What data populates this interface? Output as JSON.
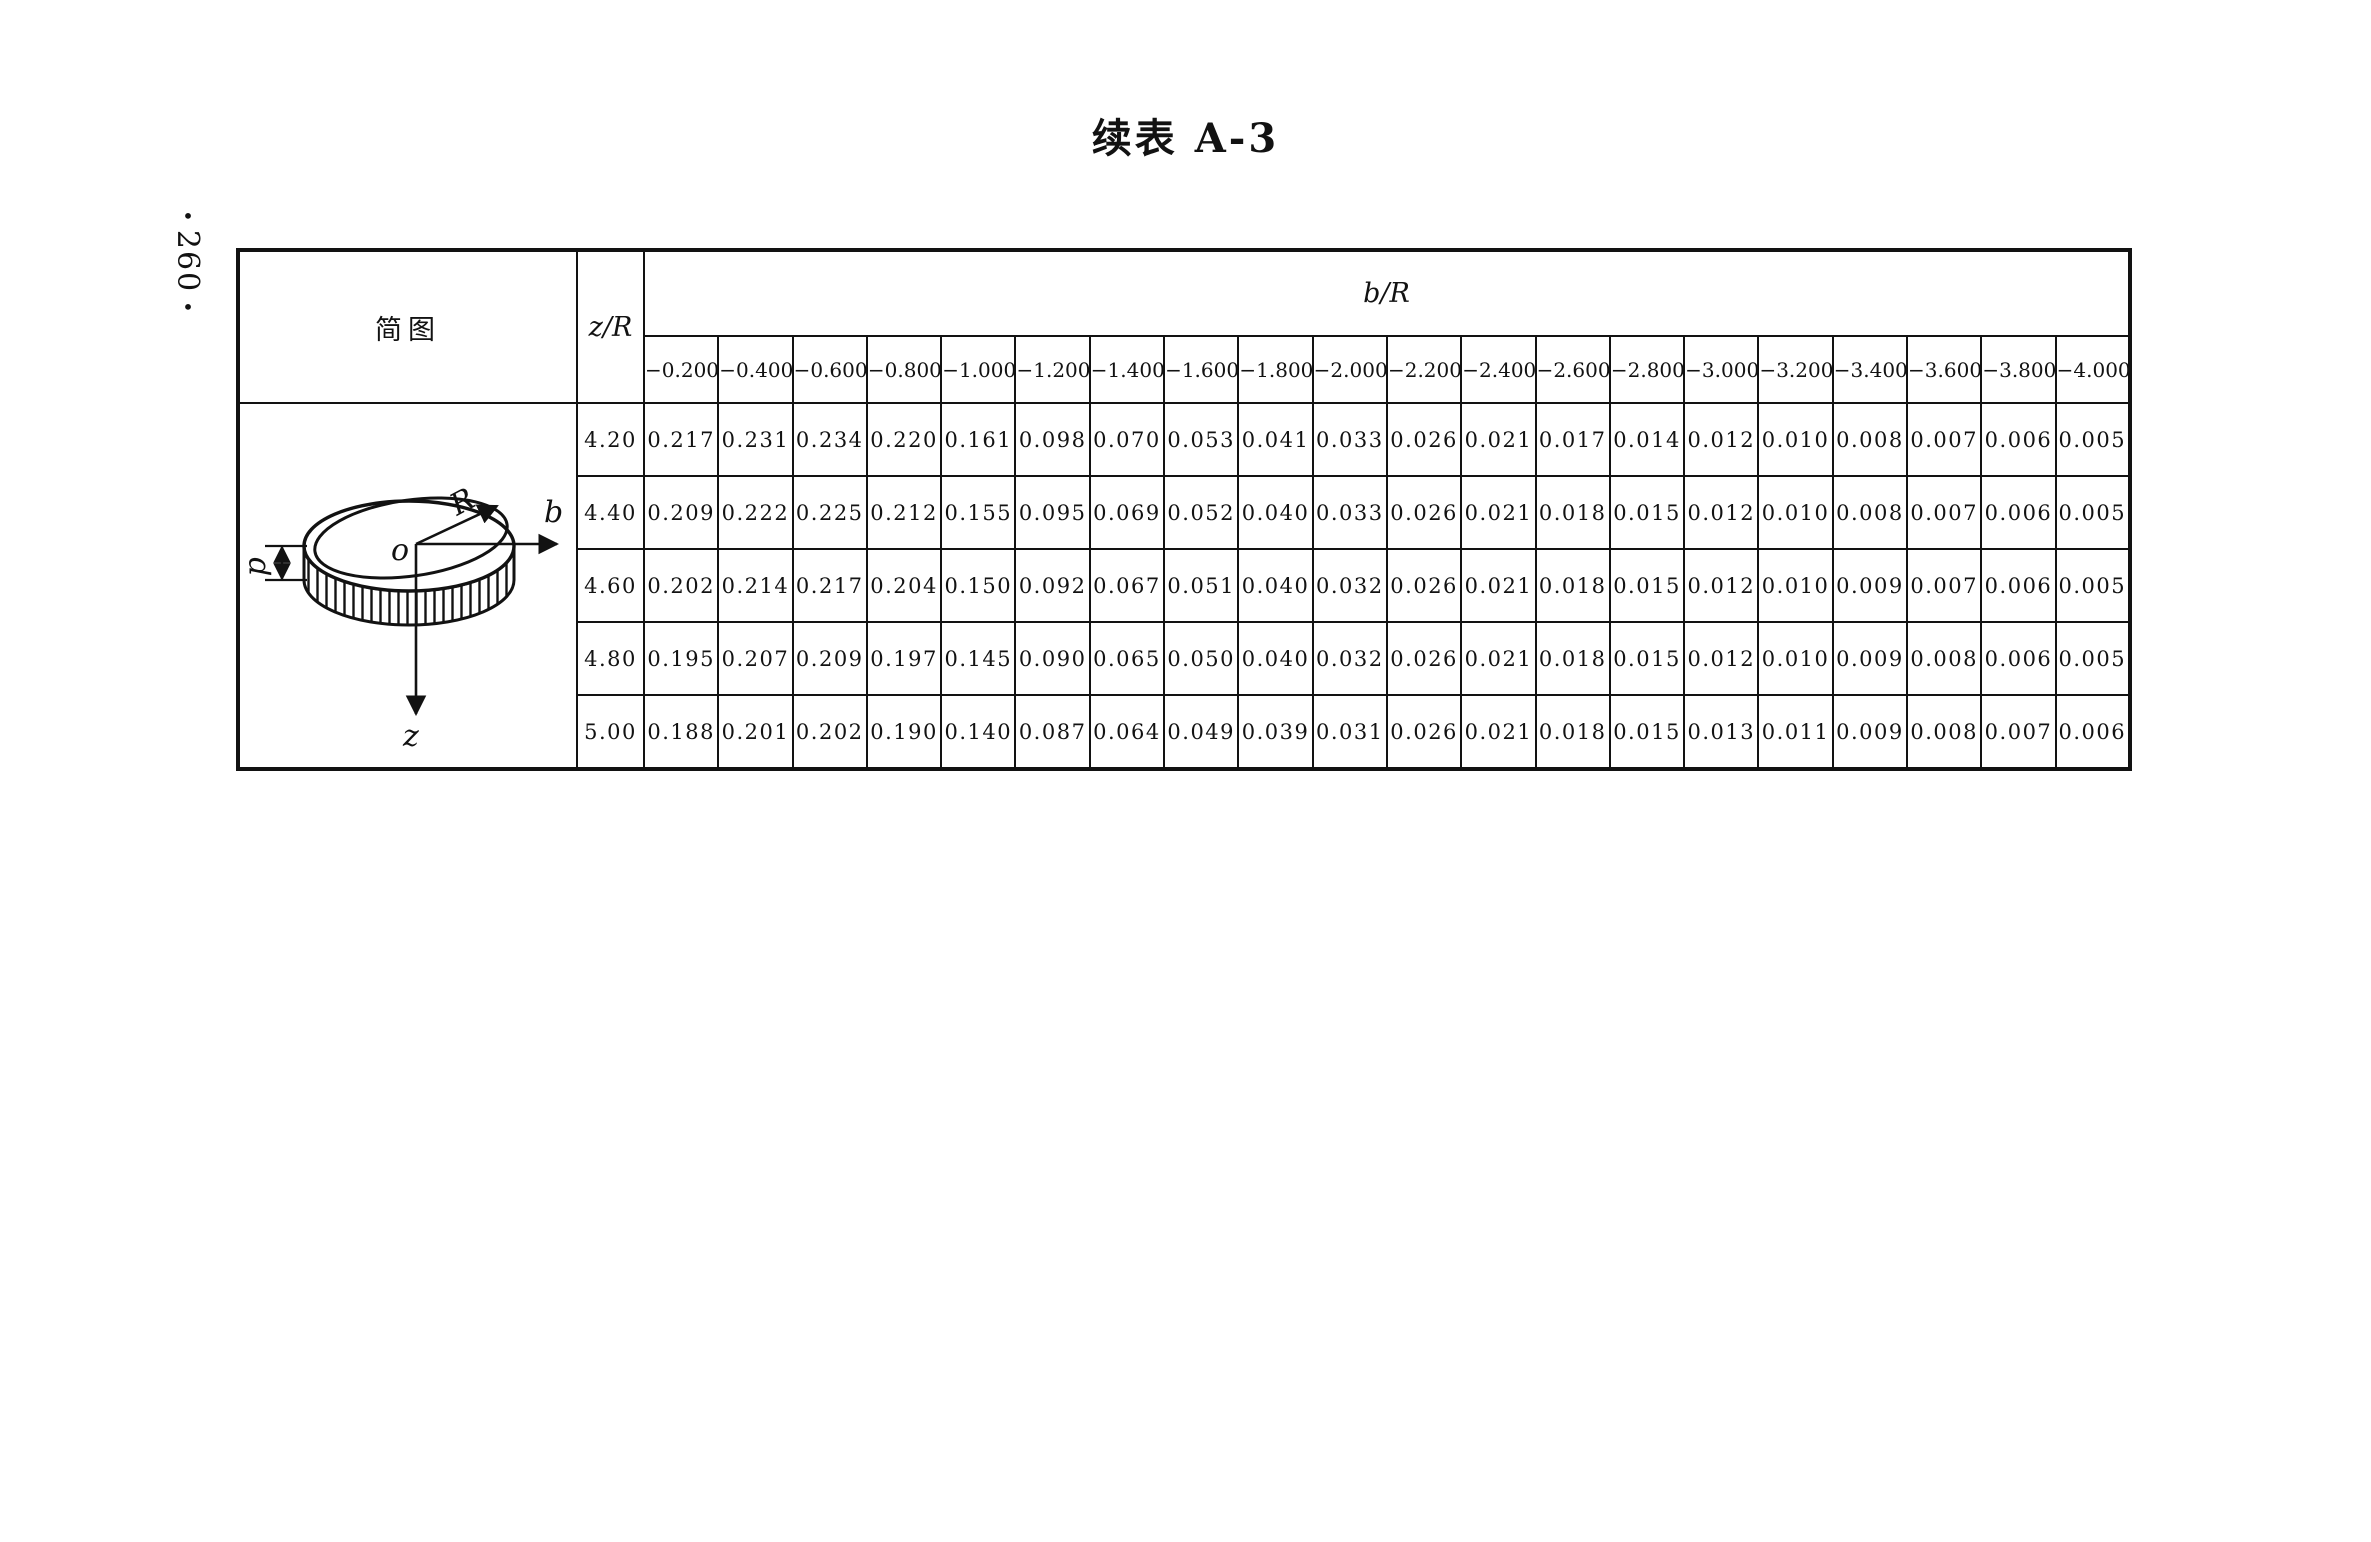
{
  "page": {
    "title": "续表 A-3",
    "page_number": "260",
    "page_number_dot": "•"
  },
  "table": {
    "diagram_header": "简图",
    "zr_header": "z/R",
    "br_header": "b/R",
    "col_headers": [
      "−0.200",
      "−0.400",
      "−0.600",
      "−0.800",
      "−1.000",
      "−1.200",
      "−1.400",
      "−1.600",
      "−1.800",
      "−2.000",
      "−2.200",
      "−2.400",
      "−2.600",
      "−2.800",
      "−3.000",
      "−3.200",
      "−3.400",
      "−3.600",
      "−3.800",
      "−4.000"
    ],
    "rows": [
      {
        "zr": "4.20",
        "values": [
          "0.217",
          "0.231",
          "0.234",
          "0.220",
          "0.161",
          "0.098",
          "0.070",
          "0.053",
          "0.041",
          "0.033",
          "0.026",
          "0.021",
          "0.017",
          "0.014",
          "0.012",
          "0.010",
          "0.008",
          "0.007",
          "0.006",
          "0.005"
        ]
      },
      {
        "zr": "4.40",
        "values": [
          "0.209",
          "0.222",
          "0.225",
          "0.212",
          "0.155",
          "0.095",
          "0.069",
          "0.052",
          "0.040",
          "0.033",
          "0.026",
          "0.021",
          "0.018",
          "0.015",
          "0.012",
          "0.010",
          "0.008",
          "0.007",
          "0.006",
          "0.005"
        ]
      },
      {
        "zr": "4.60",
        "values": [
          "0.202",
          "0.214",
          "0.217",
          "0.204",
          "0.150",
          "0.092",
          "0.067",
          "0.051",
          "0.040",
          "0.032",
          "0.026",
          "0.021",
          "0.018",
          "0.015",
          "0.012",
          "0.010",
          "0.009",
          "0.007",
          "0.006",
          "0.005"
        ]
      },
      {
        "zr": "4.80",
        "values": [
          "0.195",
          "0.207",
          "0.209",
          "0.197",
          "0.145",
          "0.090",
          "0.065",
          "0.050",
          "0.040",
          "0.032",
          "0.026",
          "0.021",
          "0.018",
          "0.015",
          "0.012",
          "0.010",
          "0.009",
          "0.008",
          "0.006",
          "0.005"
        ]
      },
      {
        "zr": "5.00",
        "values": [
          "0.188",
          "0.201",
          "0.202",
          "0.190",
          "0.140",
          "0.087",
          "0.064",
          "0.049",
          "0.039",
          "0.031",
          "0.026",
          "0.021",
          "0.018",
          "0.015",
          "0.013",
          "0.011",
          "0.009",
          "0.008",
          "0.007",
          "0.006"
        ]
      }
    ]
  },
  "diagram": {
    "labels": {
      "depth": "p",
      "radius": "R",
      "origin": "o",
      "horizontal_axis": "b",
      "vertical_axis": "z"
    }
  }
}
